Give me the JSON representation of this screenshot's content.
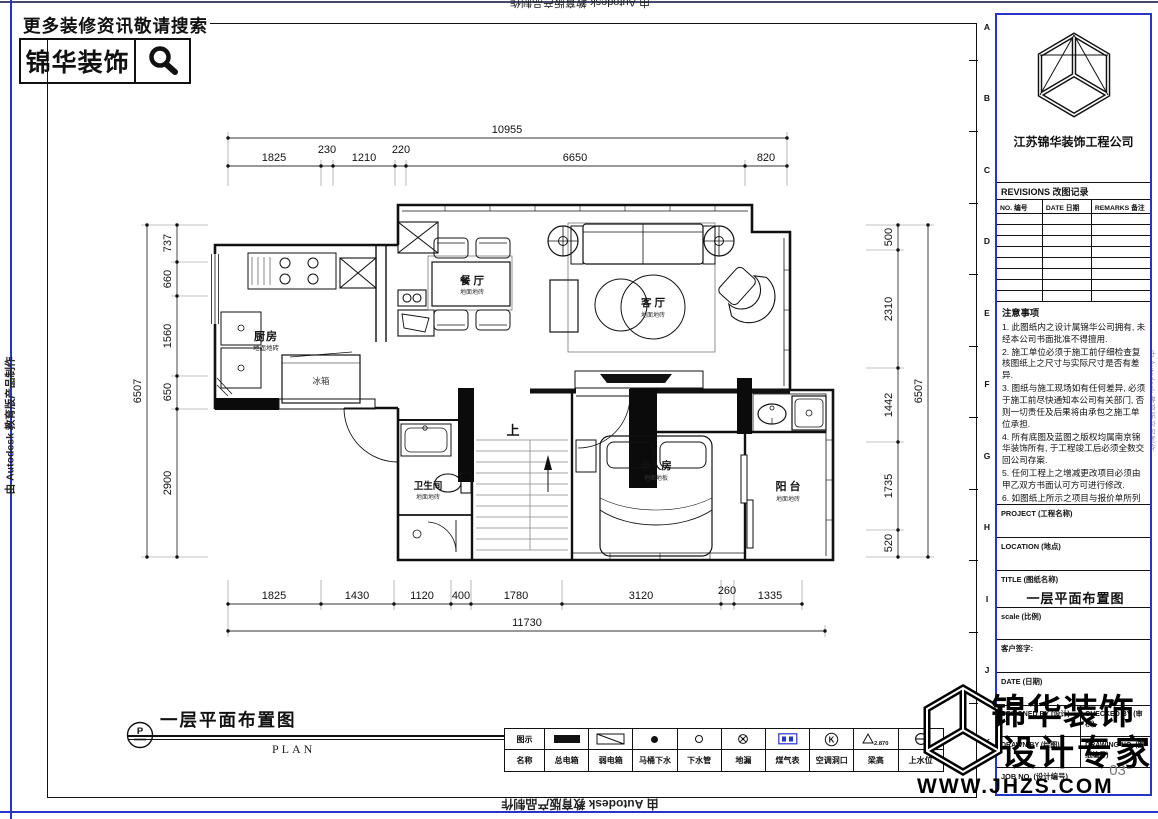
{
  "page": {
    "bg": "#ffffff",
    "line_blue": "#2535c8",
    "ink": "#111111"
  },
  "watermarks": {
    "autodesk": "由 Autodesk 教育版产品制作"
  },
  "promo": {
    "slogan": "更多装修资讯敬请搜索",
    "brand": "锦华装饰"
  },
  "sheet": {
    "border_letters": [
      "A",
      "B",
      "C",
      "D",
      "E",
      "F",
      "G",
      "H",
      "I",
      "J",
      "K"
    ]
  },
  "plan_title": {
    "symbol": "P",
    "title": "一层平面布置图",
    "subtitle": "PLAN"
  },
  "rooms": {
    "kitchen": {
      "name": "厨房",
      "floor": "地面地砖"
    },
    "dining": {
      "name": "餐 厅",
      "floor": "地面地砖"
    },
    "living": {
      "name": "客 厅",
      "floor": "地面地砖"
    },
    "bath": {
      "name": "卫生间",
      "floor": "地面地砖"
    },
    "elder": {
      "name": "老人房",
      "floor": "地面地板"
    },
    "balcony": {
      "name": "阳 台",
      "floor": "地面地砖"
    }
  },
  "annotations": {
    "fridge": "冰箱",
    "stairs_up": "上"
  },
  "dims": {
    "top": {
      "total": "10955",
      "segments": [
        "1825",
        "230",
        "1210",
        "220",
        "6650",
        "820"
      ]
    },
    "bottom": {
      "total": "11730",
      "segments": [
        "1825",
        "1430",
        "1120",
        "400",
        "1780",
        "3120",
        "260",
        "1335"
      ]
    },
    "left": {
      "total": "6507",
      "segments": [
        "737",
        "660",
        "1560",
        "650",
        "2900"
      ]
    },
    "right": {
      "total": "6507",
      "segments": [
        "500",
        "2310",
        "1442",
        "1735",
        "520"
      ]
    }
  },
  "legend": {
    "col_icon": "图示",
    "col_name": "名称",
    "beam_value": "2.870",
    "items": [
      {
        "name": "总电箱",
        "icon": "main-electric-box-icon"
      },
      {
        "name": "弱电箱",
        "icon": "weak-electric-box-icon"
      },
      {
        "name": "马桶下水",
        "icon": "toilet-drain-icon"
      },
      {
        "name": "下水管",
        "icon": "drain-pipe-icon"
      },
      {
        "name": "地漏",
        "icon": "floor-drain-icon"
      },
      {
        "name": "煤气表",
        "icon": "gas-meter-icon"
      },
      {
        "name": "空调洞口",
        "icon": "ac-opening-icon"
      },
      {
        "name": "梁高",
        "icon": "beam-height-icon"
      },
      {
        "name": "上水位",
        "icon": "water-supply-icon"
      }
    ]
  },
  "title_block": {
    "company": "江苏锦华装饰工程公司",
    "revisions_title": "REVISIONS 改图记录",
    "rev_cols": [
      "NO. 编号",
      "DATE 日期",
      "REMARKS 备注"
    ],
    "notes_title": "注意事项",
    "notes": [
      "1. 此图纸内之设计属锦华公司拥有, 未经本公司书面批准不得擅用.",
      "2. 施工单位必须于施工前仔细检查复核图纸上之尺寸与实际尺寸是否有差异.",
      "3. 图纸与施工现场如有任何差异, 必须于施工前尽快通知本公司有关部门, 否则一切责任及后果将由承包之施工单位承担.",
      "4. 所有底图及蓝图之版权均属南京锦华装饰所有, 于工程竣工后必须全数交回公司存案.",
      "5. 任何工程上之增减更改项目必须由甲乙双方书面认可方可进行修改.",
      "6. 如图纸上所示之项目与报价单所列的项目有不符时, 以报价单或合同为准.",
      "7. 不得量度图纸."
    ],
    "fields": {
      "project": "PROJECT (工程名称)",
      "location": "LOCATION (地点)",
      "title_label": "TITLE (图纸名称)",
      "title_value": "一层平面布置图",
      "scale": "scale (比例)",
      "customer_sign": "客户签字:",
      "date": "DATE (日期)",
      "designed_by": "DESIGNED BY (设计)",
      "checked_by": "CHECKED BY (审核)",
      "drawn_by": "DRAWN BY (绘图)",
      "drawing_no": "DRAWING NO. (图纸编号)",
      "drawing_no_value": "03",
      "job_no": "JOB NO. (设计编号)"
    }
  },
  "brand_watermark": {
    "line1": "锦华装饰",
    "line2": "设计专家",
    "url": "WWW.JHZS.COM"
  }
}
